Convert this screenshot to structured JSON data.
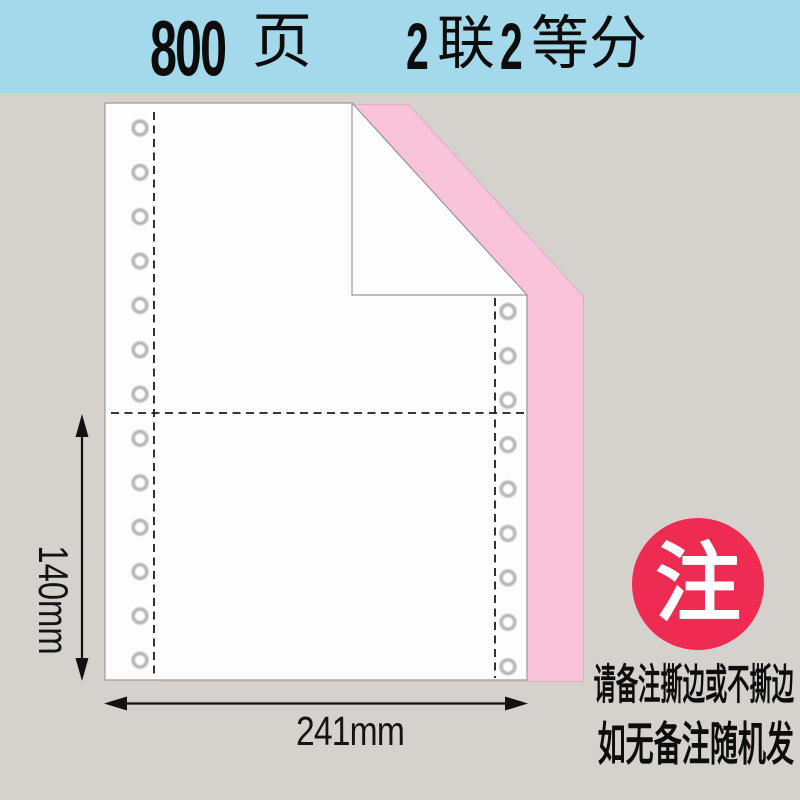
{
  "header": {
    "pages_number": "800",
    "pages_unit": "页",
    "spec_parts": [
      "2",
      "联",
      "2",
      "等分"
    ],
    "bg_color": "#a3d9ea"
  },
  "dimensions": {
    "height_label": "140mm",
    "width_label": "241mm"
  },
  "note_badge": {
    "text": "注",
    "bg_color": "#ee2b50",
    "text_color": "#ffffff"
  },
  "notes": {
    "line1": "请备注撕边或不撕边",
    "line2": "如无备注随机发"
  },
  "sheet": {
    "ply_top_color": "#fdfdfd",
    "ply_bottom_color": "#f9c3da",
    "edge_color": "#9a9a9a",
    "background_color": "#d5d2ce",
    "hole_columns": {
      "left": {
        "count": 13
      },
      "right": {
        "count": 9
      }
    }
  }
}
